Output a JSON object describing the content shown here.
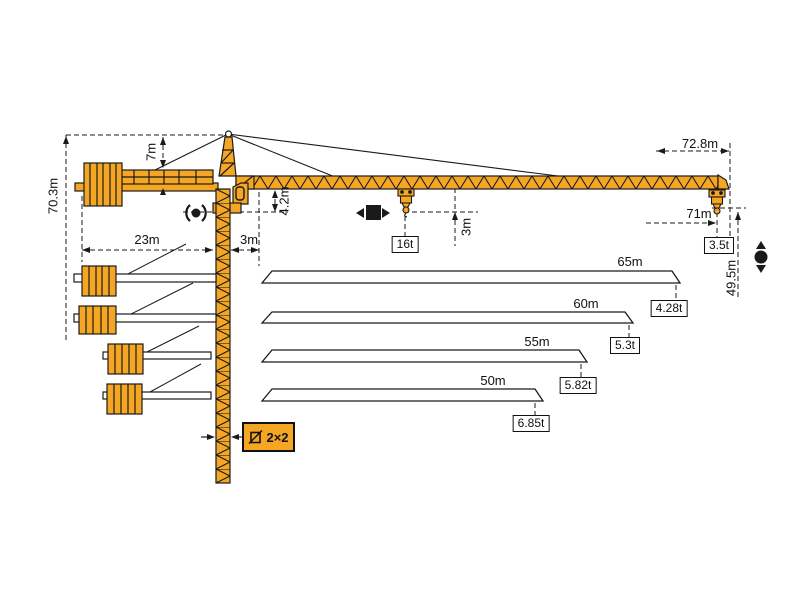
{
  "labels": {
    "total_height": "70.3m",
    "tower_head_height": "7m",
    "counterjib_radius": "23m",
    "rear_clearance": "3m",
    "jib_depth": "4.2m",
    "hook_to_jib": "3m",
    "max_capacity": "16t",
    "max_radius": "72.8m",
    "max_hook_radius": "71m",
    "tip_capacity": "3.5t",
    "hook_height": "49.5m",
    "mast_section": "2×2"
  },
  "jib_variants": [
    {
      "length": "65m",
      "tip_load": "4.28t"
    },
    {
      "length": "60m",
      "tip_load": "5.3t"
    },
    {
      "length": "55m",
      "tip_load": "5.82t"
    },
    {
      "length": "50m",
      "tip_load": "6.85t"
    }
  ],
  "colors": {
    "crane_orange": "#F5A623",
    "outline": "#1A1A1A",
    "background": "#FFFFFF"
  }
}
